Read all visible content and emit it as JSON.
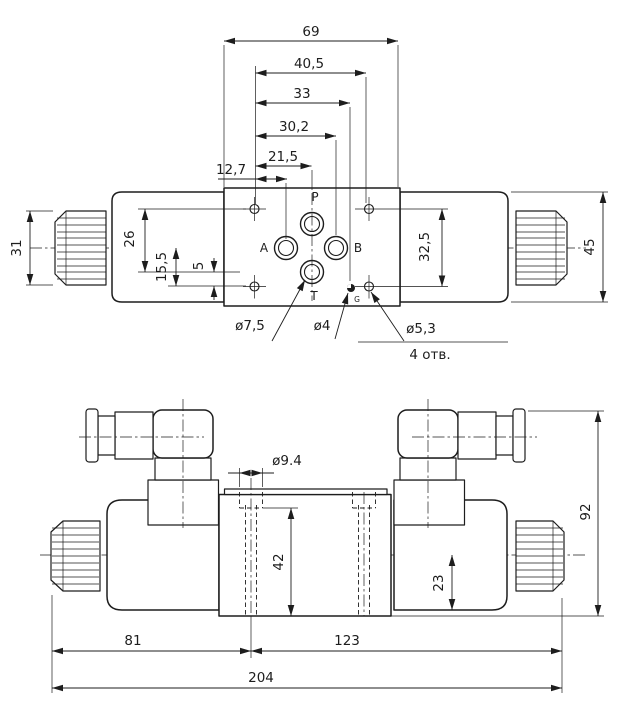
{
  "colors": {
    "line": "#1d1d1d",
    "background": "#ffffff"
  },
  "plan_view": {
    "ports": {
      "pressure": "P",
      "work_a": "A",
      "work_b": "B",
      "tank": "T",
      "gauge": "G"
    },
    "dimensions": {
      "body_width": "69",
      "mount_span": "40,5",
      "gauge_x": "33",
      "port_b_x": "30,2",
      "port_pt_x": "21,5",
      "port_a_x": "12,7",
      "knob_height": "31",
      "pt_row": "26",
      "ab_row": "15,5",
      "t_offset": "5",
      "mount_rows": "32,5",
      "tube_height": "45"
    },
    "callouts": {
      "t_port_dia": "ø7,5",
      "gauge_dia": "ø4",
      "mount_dia": "ø5,3",
      "mount_qty": "4 отв."
    }
  },
  "front_view": {
    "dimensions": {
      "hole_dia": "ø9.4",
      "hole_depth": "42",
      "coil_half": "23",
      "total_height": "92",
      "left_len": "81",
      "right_len": "123",
      "total_len": "204"
    }
  }
}
